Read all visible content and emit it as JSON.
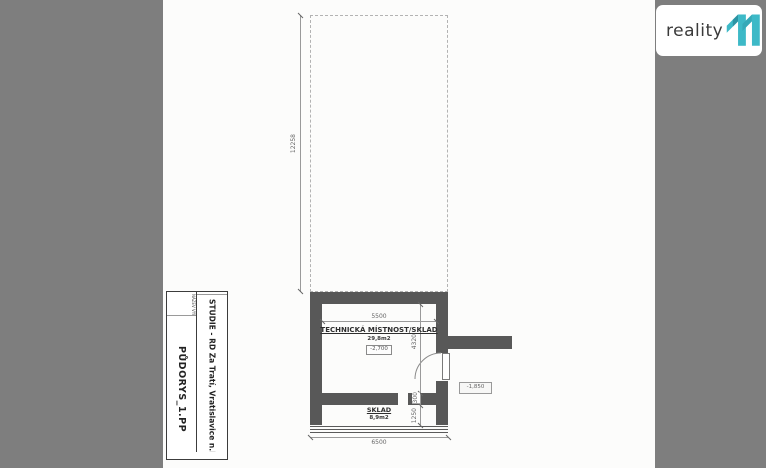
{
  "logo": {
    "brand": "reality",
    "brand_number": "11",
    "accent_color": "#3db9c7",
    "text_color": "#3a3a3a"
  },
  "title_block": {
    "project": {
      "label": "NÁZEV AKCE",
      "value": "STUDIE - RD Za Tratí, Vratislavice n.N."
    },
    "drawing": {
      "label": "NÁZEV VÝKRESU",
      "value": "PŮDORYS_1.PP"
    }
  },
  "plan": {
    "room_main": {
      "name": "TECHNICKÁ MÍSTNOST/SKLAD",
      "area": "29,8m2",
      "level": "-2,700"
    },
    "room_storage": {
      "name": "SKLAD",
      "area": "8,9m2"
    },
    "outside_level": "-1,850",
    "dims": {
      "outline_height": "12258",
      "inner_width": "5500",
      "room_height": "4320",
      "wall_thickness": "300",
      "storage_height": "1250",
      "outer_width": "6500"
    }
  },
  "colors": {
    "background": "#7e7e7e",
    "paper": "#fcfcfb",
    "wall": "#585858"
  }
}
